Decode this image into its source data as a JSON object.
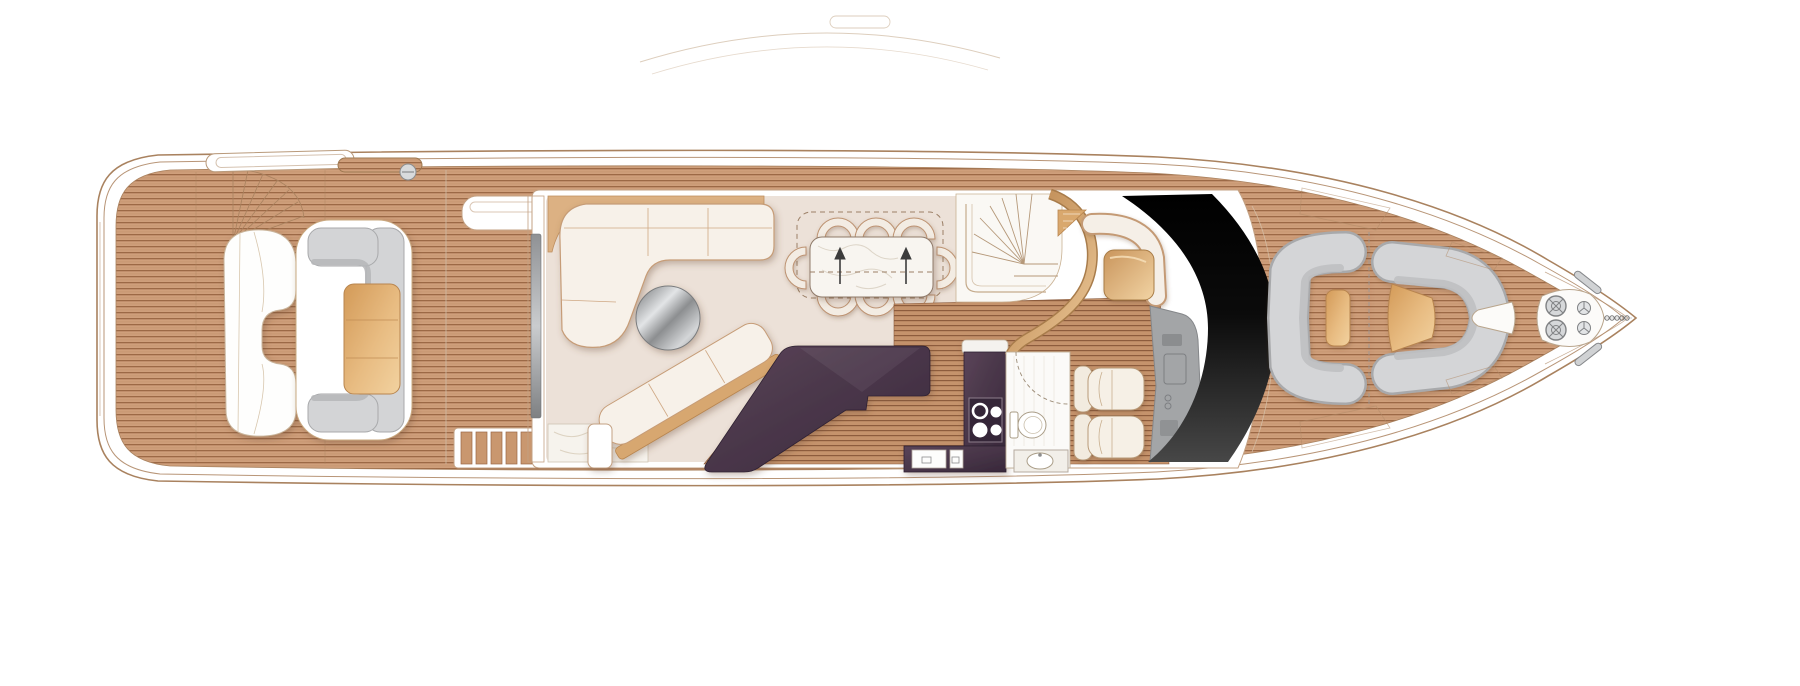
{
  "canvas": {
    "width": 1800,
    "height": 686,
    "background": "#ffffff"
  },
  "palette": {
    "hull_line": "#a9825f",
    "teak": "#cf9f7b",
    "teak_seam": "#9c6946",
    "galley_teak": "#c5936c",
    "superstructure_white": "#ffffff",
    "salon_floor": "#ece1d8",
    "marble": "#f6f3ed",
    "upholstery_cream": "#f7f1e9",
    "upholstery_trim": "#c69c77",
    "cushion_gray": "#d3d4d6",
    "cushion_shade": "#b5b6b8",
    "table_tan": "#dfaa6e",
    "counter_aubergine": "#4a3544",
    "windshield_black": "#0b0b0b",
    "console_gray": "#a3a5a7",
    "metal_gray": "#d6d8da",
    "bronze": "#c9955c"
  },
  "regions": {
    "hull": {
      "label": "hull outline"
    },
    "aft_deck": {
      "label": "aft deck with teak planking"
    },
    "aft_seating": {
      "label": "aft deck C-sofa with table and loungers"
    },
    "cockpit_steps": {
      "label": "cockpit side steps"
    },
    "salon": {
      "label": "main salon"
    },
    "salon_sofa": {
      "label": "L-shaped salon sofa"
    },
    "coffee_table": {
      "label": "round coffee table"
    },
    "dining": {
      "label": "dining table with chairs"
    },
    "staircase": {
      "label": "curved companionway staircase"
    },
    "galley": {
      "label": "galley with aubergine counters"
    },
    "day_head": {
      "label": "day head with toilet and sink"
    },
    "helm": {
      "label": "helm station with two seats"
    },
    "windshield": {
      "label": "black wraparound windshield"
    },
    "foredeck": {
      "label": "foredeck seating area"
    },
    "bow_gear": {
      "label": "bow anchor windlass"
    }
  },
  "furniture": {
    "dining": {
      "chair_count": 8,
      "extension_arrows": 2
    },
    "cooktop": {
      "burner_count": 4
    },
    "helm": {
      "seat_count": 2
    },
    "windlass": {
      "drum_count": 2,
      "wheel_count": 2,
      "cleat_count": 2
    }
  }
}
